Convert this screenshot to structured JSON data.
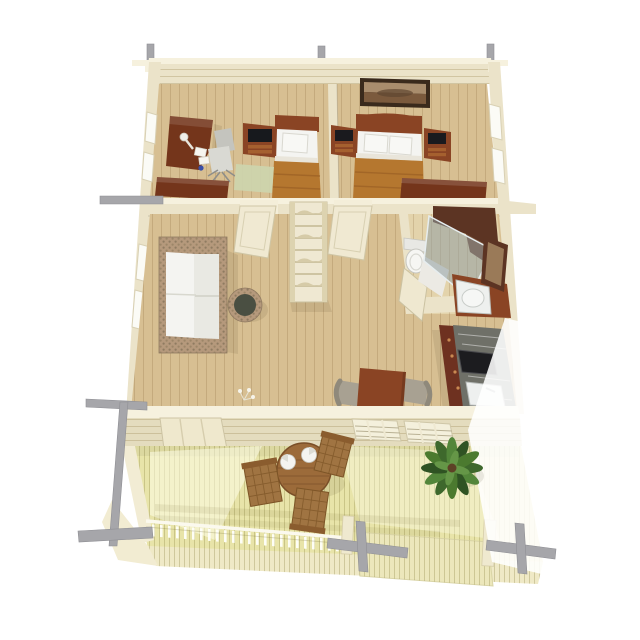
{
  "meta": {
    "view": "3d-floor-plan-top-view",
    "description": "Isometric top-down 3D render of a one-storey wooden cabin: two bedrooms at the top, hallway with shelf unit, living room with sofa, bathroom with shower, kitchenette, dining corner, and a large front terrace with outdoor furniture and a palm plant"
  },
  "palette": {
    "wall_cream": "#ebe3c9",
    "wall_light": "#f6f1de",
    "wall_face": "#e4dcbe",
    "floor_wood": "#d7bf92",
    "floor_bath": "#e3d3ab",
    "deck_wood": "#e8e4a9",
    "furniture_dark": "#74351b",
    "furniture_dark2": "#8a4424",
    "white_fabric": "#f4f4f1",
    "beam_grey": "#a6a6aa",
    "wood_outdoor": "#a07442",
    "chair_grey": "#a8a192",
    "blanket": "#b5772f",
    "glass": "#9aa7ab",
    "marble": "#6f7068",
    "plant_green": "#4b7a2f",
    "rug_green": "#cdd5ae",
    "wicker": "#b5997c"
  },
  "scene": {
    "rooms": [
      {
        "name": "bedroom-left",
        "furniture": [
          "corner-desk",
          "desk-lamp",
          "papers",
          "office-chair",
          "tv-stand",
          "single-bed",
          "dresser",
          "green-rug"
        ]
      },
      {
        "name": "bedroom-right",
        "furniture": [
          "wall-picture",
          "double-bed",
          "nightstand-left",
          "nightstand-right",
          "blanket-chest"
        ]
      },
      {
        "name": "hallway",
        "furniture": [
          "shelf-unit",
          "bedroom-door-left",
          "bedroom-door-right"
        ]
      },
      {
        "name": "living-room",
        "furniture": [
          "wicker-sofa",
          "wicker-ottoman",
          "floor-flower"
        ]
      },
      {
        "name": "bathroom",
        "furniture": [
          "toilet",
          "corner-shower",
          "sink-vanity",
          "wall-mirror",
          "bathroom-door"
        ]
      },
      {
        "name": "kitchen",
        "furniture": [
          "counter",
          "stove",
          "kitchen-sink"
        ]
      },
      {
        "name": "dining-area",
        "furniture": [
          "dining-table",
          "dining-chair-left",
          "dining-chair-right"
        ]
      },
      {
        "name": "terrace",
        "furniture": [
          "front-door",
          "slatted-window-1",
          "slatted-window-2",
          "round-table",
          "plate-1",
          "plate-2",
          "terrace-chair-1",
          "terrace-chair-2",
          "terrace-chair-3",
          "potted-palm",
          "railing",
          "deck-steps"
        ]
      }
    ],
    "structure": [
      "roof-beam-posts",
      "corner-brackets",
      "cut-roof-beam-crosses",
      "log-walls"
    ]
  }
}
